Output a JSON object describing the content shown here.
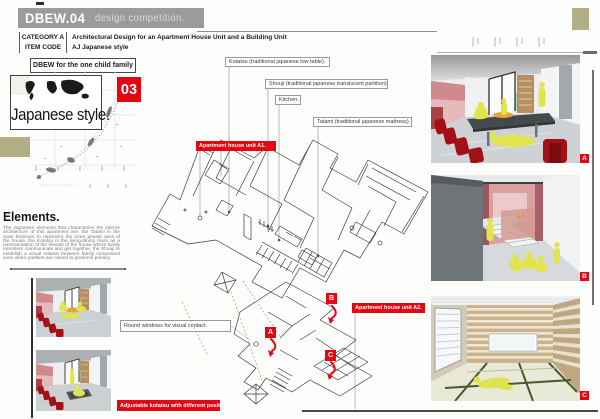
{
  "header": {
    "title": "DBEW.04",
    "subtitle": "design competition.",
    "rows": [
      {
        "label": "CATEGORY A",
        "value": "Architectural Design for an Apartment House Unit and a Building Unit"
      },
      {
        "label": "ITEM CODE",
        "value": "AJ Japanese style"
      }
    ],
    "family_note": "DBEW for the one child family"
  },
  "intro": {
    "style_title": "Japanese style.",
    "page_number": "03",
    "elements_heading": "Elements.",
    "elements_text": "The Japanese elements that characterize the interior architecture of this apartment are: the Tatami in the main bedroom to represent the more private area of the house, the Kotatsu in the living-dining room as a representation of the fireside of the house where family members communicate and get together, the Shouji to establish a visual relation between family component even when partition are closed to preserve privacy."
  },
  "captions": {
    "round_windows": "Round windows for visual contact.",
    "adjustable_kotatsu": "Adjustable kotatsu with different position."
  },
  "callouts": {
    "kotatsu": "Kotatsu (traditional japanese low table).",
    "shouji": "Shouji (traditional japanese translucent partition).",
    "kitchen": "Kitchen.",
    "tatami": "Tatami (traditional japanese mattress).",
    "unit_a1": "Apartment house unit A1.",
    "unit_a2": "Apartment house unit A2."
  },
  "plan_markers": {
    "a": "A",
    "b": "B",
    "c": "C"
  },
  "photo_badges": {
    "a": "A",
    "b": "B",
    "c": "C"
  },
  "colors": {
    "accent_red": "#e30613",
    "olive_khaki": "#b2ae85",
    "header_gray": "#9b9b9b",
    "figure_yellow": "#e0e44f"
  },
  "icons": {
    "world_map": "world-map-icon",
    "japan_map": "japan-map-icon"
  }
}
